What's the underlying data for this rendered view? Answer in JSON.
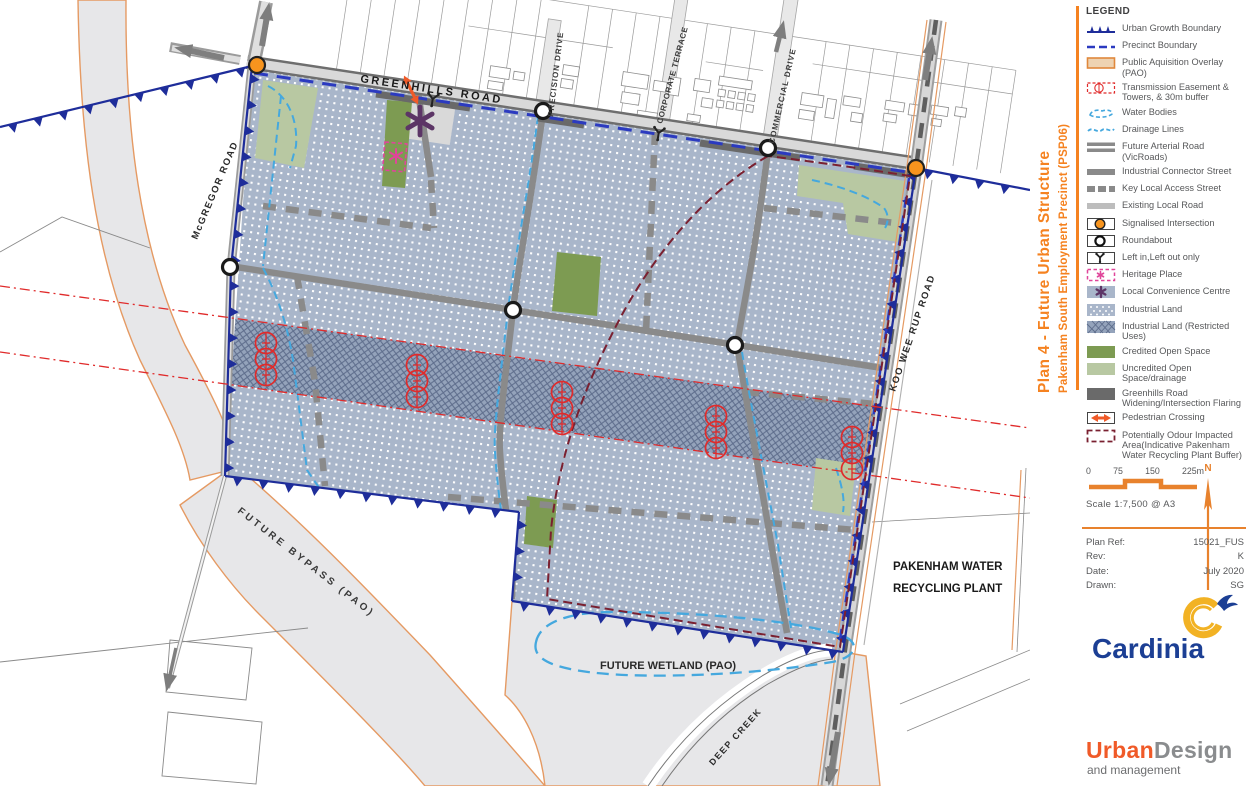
{
  "title": {
    "line1": "Plan 4 - Future Urban Structure",
    "line2": "Pakenham South Employment Precinct  (PSP06)"
  },
  "legend": {
    "heading": "LEGEND",
    "items": [
      {
        "type": "ugb",
        "label": "Urban Growth Boundary"
      },
      {
        "type": "precinct",
        "label": "Precinct Boundary"
      },
      {
        "type": "pao",
        "label": "Public Aquisition Overlay (PAO)"
      },
      {
        "type": "transmission",
        "label": "Transmission Easement & Towers, & 30m buffer"
      },
      {
        "type": "water",
        "label": "Water Bodies"
      },
      {
        "type": "drainage",
        "label": "Drainage Lines"
      },
      {
        "type": "arterial",
        "label": "Future Arterial Road (VicRoads)"
      },
      {
        "type": "connector",
        "label": "Industrial Connector Street"
      },
      {
        "type": "keyaccess",
        "label": "Key Local Access Street"
      },
      {
        "type": "existing",
        "label": "Existing Local Road"
      },
      {
        "type": "signal",
        "label": "Signalised Intersection"
      },
      {
        "type": "roundabout",
        "label": "Roundabout"
      },
      {
        "type": "leftinout",
        "label": "Left in,Left out only"
      },
      {
        "type": "heritage",
        "label": "Heritage Place"
      },
      {
        "type": "lcc",
        "label": "Local Convenience Centre"
      },
      {
        "type": "industrial",
        "label": "Industrial Land"
      },
      {
        "type": "restricted",
        "label": "Industrial Land (Restricted Uses)"
      },
      {
        "type": "credited",
        "label": "Credited Open Space"
      },
      {
        "type": "uncredited",
        "label": "Uncredited Open Space/drainage"
      },
      {
        "type": "widening",
        "label": "Greenhills Road Widening/Intersection Flaring"
      },
      {
        "type": "pedestrian",
        "label": "Pedestrian Crossing"
      },
      {
        "type": "odour",
        "label": "Potentially Odour Impacted Area(Indicative Pakenham Water Recycling Plant Buffer)"
      }
    ]
  },
  "scalebar": {
    "ticks": [
      "0",
      "75",
      "150",
      "225m"
    ],
    "caption": "Scale 1:7,500 @ A3",
    "north_label": "N"
  },
  "plan_ref": {
    "rows": [
      {
        "label": "Plan Ref:",
        "value": "15021_FUS"
      },
      {
        "label": "Rev:",
        "value": "K"
      },
      {
        "label": "Date:",
        "value": "July 2020"
      },
      {
        "label": "Drawn:",
        "value": "SG"
      }
    ]
  },
  "logos": {
    "cardinia": "Cardinia",
    "urban": "Urban",
    "design": "Design",
    "management": "and management"
  },
  "map_labels": {
    "greenhills": "GREENHILLS  ROAD",
    "mcgregor": "McGREGOR  ROAD",
    "koowee": "KOO WEE RUP  ROAD",
    "precision": "PRECISION  DRIVE",
    "corporate": "CORPORATE  TERRACE",
    "commercial": "COMMERCIAL  DRIVE",
    "bypass": "FUTURE BYPASS (PAO)",
    "wetland": "FUTURE WETLAND (PAO)",
    "plant1": "PAKENHAM WATER",
    "plant2": "RECYCLING PLANT",
    "creek": "DEEP  CREEK"
  },
  "colors": {
    "accent_orange": "#f58220",
    "ugb_navy": "#1e2d9a",
    "precinct_blue": "#2b3ac0",
    "industrial_fill": "#a9b6ca",
    "restricted_fill": "#94a3bb",
    "credited_green": "#7d9b52",
    "uncredited_green": "#b8c8a2",
    "road_gray": "#8a8a8a",
    "widening_gray": "#6a6a6a",
    "pao_fill": "#e7e7e9",
    "pao_border": "#e59a63",
    "legend_pao_fill": "#eed3b2",
    "water_blue": "#45a8de",
    "transmission_red": "#e02b2b",
    "odour_maroon": "#7a2030",
    "heritage_pink": "#e0459a",
    "lcc_purple": "#5c3566",
    "signal_orange": "#f7941e",
    "pedestrian_orange": "#f05a28",
    "cardinia_blue": "#1c3f94",
    "cardinia_gold": "#f2b224",
    "logo_gray": "#8a8c8e",
    "legend_text_gray": "#57585a"
  }
}
